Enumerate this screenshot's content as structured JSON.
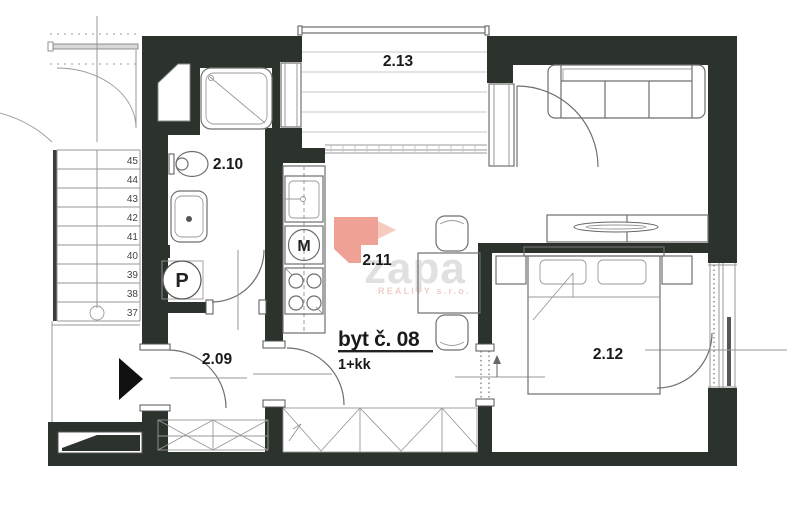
{
  "plan": {
    "unit": {
      "title": "byt č. 08",
      "layout": "1+kk"
    },
    "rooms": {
      "hall": {
        "label": "2.09"
      },
      "bathroom": {
        "label": "2.10"
      },
      "living": {
        "label": "2.11"
      },
      "bedroom": {
        "label": "2.12"
      },
      "balcony": {
        "label": "2.13"
      }
    },
    "appliances": {
      "washer": "P",
      "kitchen_unit": "M"
    },
    "stairs": {
      "numbers": [
        "45",
        "44",
        "43",
        "42",
        "41",
        "40",
        "39",
        "38",
        "37"
      ]
    },
    "watermark": {
      "brand": "zapa",
      "subtitle": "REALITY s.r.o."
    },
    "colors": {
      "wall": "#2b332c",
      "furniture_line": "#6f6f6f",
      "logo": "#ec9485",
      "logo_light": "#f6c2b3",
      "brand_text": "#d9d9d9",
      "brand_sub": "#edcfc7"
    }
  }
}
